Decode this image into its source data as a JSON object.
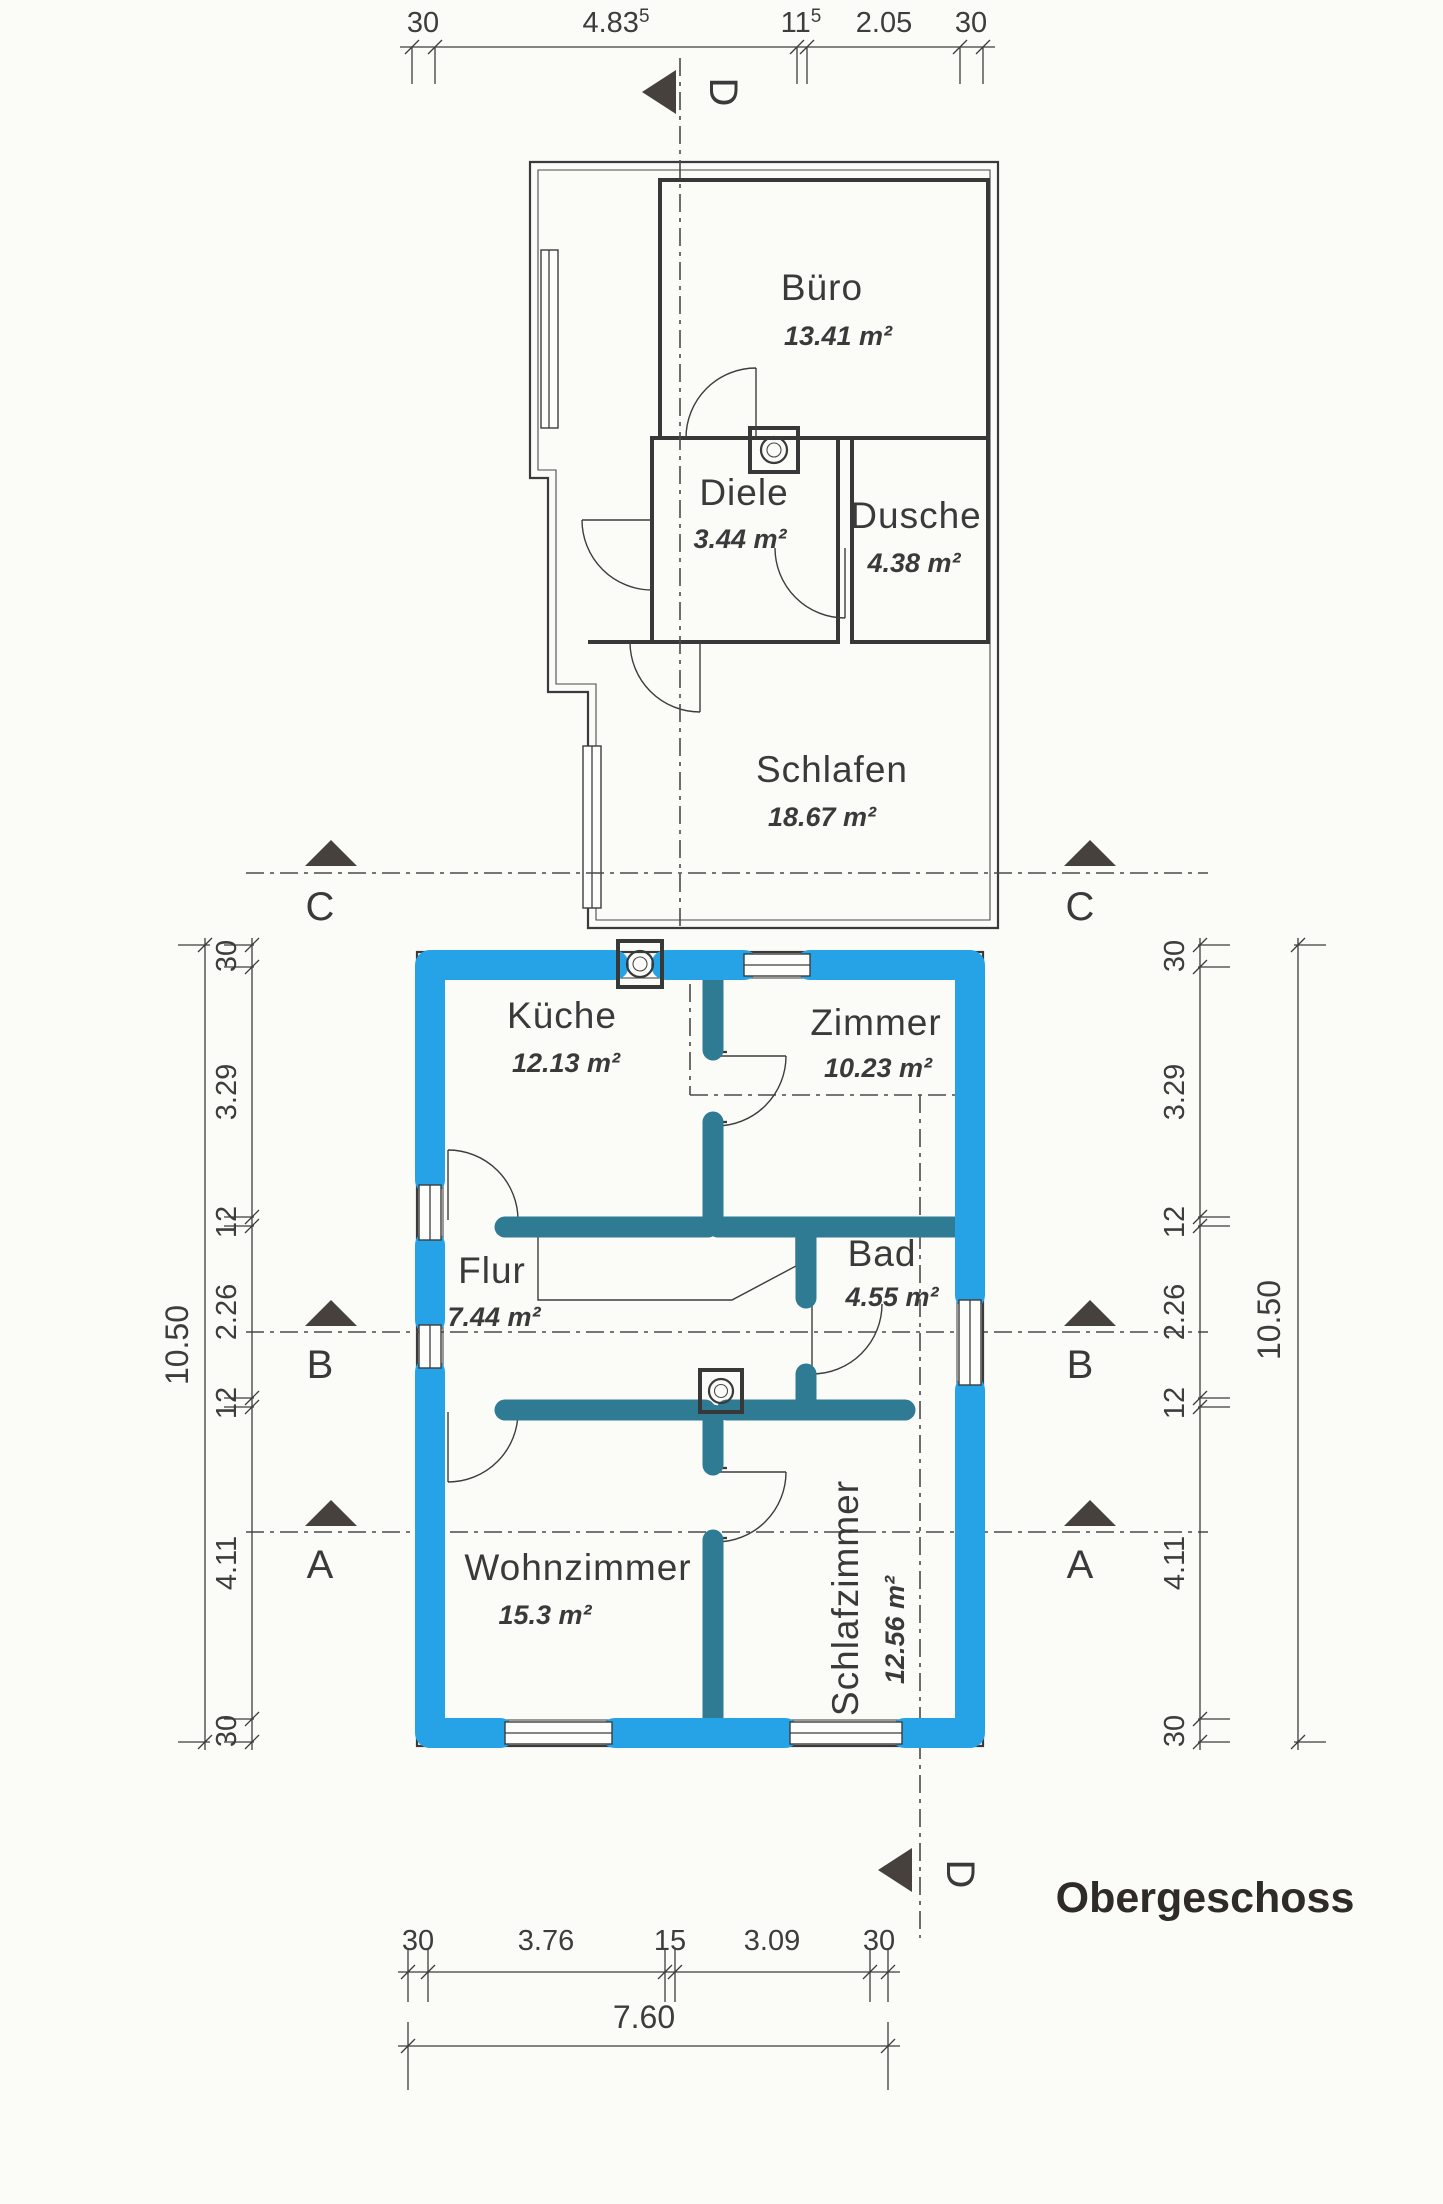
{
  "plan_title": "Obergeschoss",
  "colors": {
    "highlight_wall": "#26a3e6",
    "interior_wall": "#2f7b93",
    "ink": "#3d3d3d"
  },
  "sections": {
    "a": "A",
    "b": "B",
    "c": "C",
    "d": "D"
  },
  "upper_floor": {
    "rooms": [
      {
        "name": "Büro",
        "area": "13.41 m²"
      },
      {
        "name": "Diele",
        "area": "3.44 m²"
      },
      {
        "name": "Dusche",
        "area": "4.38 m²"
      },
      {
        "name": "Schlafen",
        "area": "18.67 m²"
      }
    ]
  },
  "lower_floor": {
    "rooms": [
      {
        "name": "Küche",
        "area": "12.13 m²"
      },
      {
        "name": "Zimmer",
        "area": "10.23 m²"
      },
      {
        "name": "Flur",
        "area": "7.44 m²"
      },
      {
        "name": "Bad",
        "area": "4.55 m²"
      },
      {
        "name": "Wohnzimmer",
        "area": "15.3 m²"
      },
      {
        "name": "Schlafzimmer",
        "area": "12.56 m²"
      }
    ]
  },
  "dimensions": {
    "top": {
      "segments": [
        {
          "v": "30"
        },
        {
          "v": "4.83",
          "sup": "5"
        },
        {
          "v": "11",
          "sup": "5"
        },
        {
          "v": "2.05"
        },
        {
          "v": "30"
        }
      ]
    },
    "left": {
      "segments": [
        {
          "v": "30"
        },
        {
          "v": "3.29"
        },
        {
          "v": "12"
        },
        {
          "v": "2.26"
        },
        {
          "v": "12"
        },
        {
          "v": "4.11"
        },
        {
          "v": "30"
        }
      ],
      "total": "10.50"
    },
    "right": {
      "segments": [
        {
          "v": "30"
        },
        {
          "v": "3.29"
        },
        {
          "v": "12"
        },
        {
          "v": "2.26"
        },
        {
          "v": "12"
        },
        {
          "v": "4.11"
        },
        {
          "v": "30"
        }
      ],
      "total": "10.50"
    },
    "bottom": {
      "segments": [
        {
          "v": "30"
        },
        {
          "v": "3.76"
        },
        {
          "v": "15"
        },
        {
          "v": "3.09"
        },
        {
          "v": "30"
        }
      ],
      "total": "7.60"
    }
  }
}
